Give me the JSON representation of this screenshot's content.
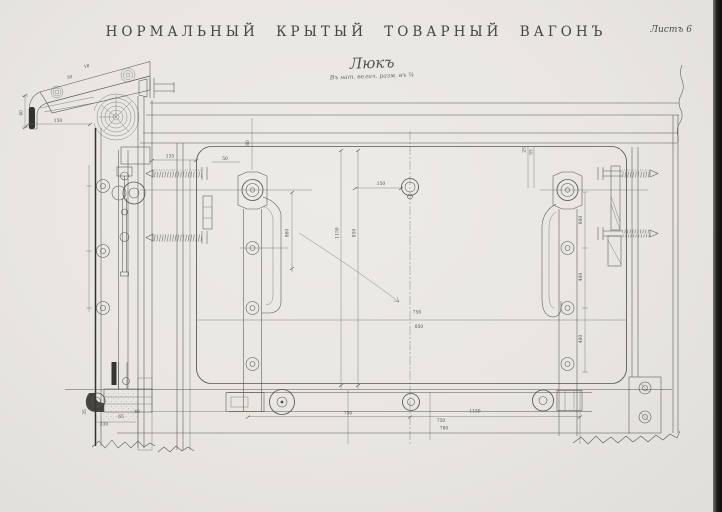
{
  "page": {
    "title": "НОРМАЛЬНЫЙ КРЫТЫЙ ТОВАРНЫЙ ВАГОНЪ",
    "sheet_label": "Листъ 6",
    "drawing_title": "Люкъ",
    "drawing_note": "Въ нат. велич. разм. въ ¾",
    "paper_color": "#e9e6e2",
    "ink_color": "#56544e",
    "dark_ink_color": "#33312c",
    "page_edge_color": "#141412"
  },
  "dims": [
    "860",
    "1150",
    "850",
    "800",
    "400",
    "750",
    "850",
    "750",
    "1150",
    "750",
    "760",
    "150",
    "40",
    "80",
    "50",
    "135",
    "150",
    "25",
    "55",
    "330",
    "65",
    "40",
    "35",
    "30",
    "18",
    "400"
  ]
}
